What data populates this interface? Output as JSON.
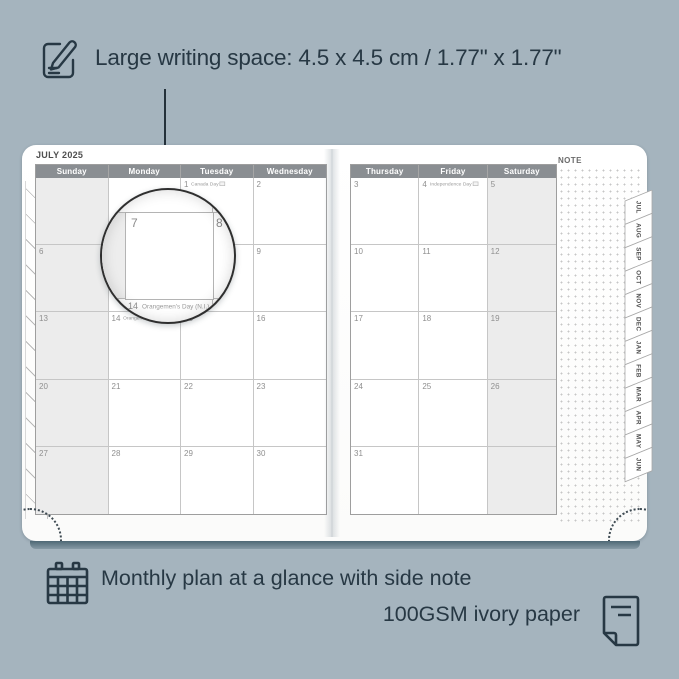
{
  "colors": {
    "background": "#a5b4be",
    "ink": "#273844",
    "header_bar": "#8a8e92",
    "weekend_shade": "#ececec",
    "page_white": "#ffffff"
  },
  "top_annotation": {
    "text": "Large writing space: 4.5 x 4.5 cm / 1.77\" x 1.77\""
  },
  "planner": {
    "month_title": "JULY 2025",
    "note_label": "NOTE",
    "left_page": {
      "headers": [
        "Sunday",
        "Monday",
        "Tuesday",
        "Wednesday"
      ],
      "shaded_column": 0,
      "rows": [
        [
          {
            "num": "",
            "holiday": ""
          },
          {
            "num": "",
            "holiday": ""
          },
          {
            "num": "1",
            "holiday": "Canada Day"
          },
          {
            "num": "2",
            "holiday": ""
          }
        ],
        [
          {
            "num": "6",
            "holiday": ""
          },
          {
            "num": "7",
            "holiday": ""
          },
          {
            "num": "8",
            "holiday": ""
          },
          {
            "num": "9",
            "holiday": ""
          }
        ],
        [
          {
            "num": "13",
            "holiday": ""
          },
          {
            "num": "14",
            "holiday": "Orangemen's Day (N.I.)"
          },
          {
            "num": "15",
            "holiday": ""
          },
          {
            "num": "16",
            "holiday": ""
          }
        ],
        [
          {
            "num": "20",
            "holiday": ""
          },
          {
            "num": "21",
            "holiday": ""
          },
          {
            "num": "22",
            "holiday": ""
          },
          {
            "num": "23",
            "holiday": ""
          }
        ],
        [
          {
            "num": "27",
            "holiday": ""
          },
          {
            "num": "28",
            "holiday": ""
          },
          {
            "num": "29",
            "holiday": ""
          },
          {
            "num": "30",
            "holiday": ""
          }
        ]
      ]
    },
    "right_page": {
      "headers": [
        "Thursday",
        "Friday",
        "Saturday"
      ],
      "shaded_column": 2,
      "rows": [
        [
          {
            "num": "3",
            "holiday": ""
          },
          {
            "num": "4",
            "holiday": "Independence Day"
          },
          {
            "num": "5",
            "holiday": ""
          }
        ],
        [
          {
            "num": "10",
            "holiday": ""
          },
          {
            "num": "11",
            "holiday": ""
          },
          {
            "num": "12",
            "holiday": ""
          }
        ],
        [
          {
            "num": "17",
            "holiday": ""
          },
          {
            "num": "18",
            "holiday": ""
          },
          {
            "num": "19",
            "holiday": ""
          }
        ],
        [
          {
            "num": "24",
            "holiday": ""
          },
          {
            "num": "25",
            "holiday": ""
          },
          {
            "num": "26",
            "holiday": ""
          }
        ],
        [
          {
            "num": "31",
            "holiday": ""
          },
          {
            "num": "",
            "holiday": ""
          },
          {
            "num": "",
            "holiday": ""
          }
        ]
      ]
    },
    "month_tabs": [
      "JUL",
      "AUG",
      "SEP",
      "OCT",
      "NOV",
      "DEC",
      "JAN",
      "FEB",
      "MAR",
      "APR",
      "MAY",
      "JUN"
    ]
  },
  "magnifier": {
    "left_day": "7",
    "right_day": "8",
    "bottom_day": "14",
    "bottom_holiday": "Orangemen's Day (N.I.)"
  },
  "bottom_annotation": {
    "line1": "Monthly plan at a glance with side note",
    "line2": "100GSM ivory paper"
  }
}
